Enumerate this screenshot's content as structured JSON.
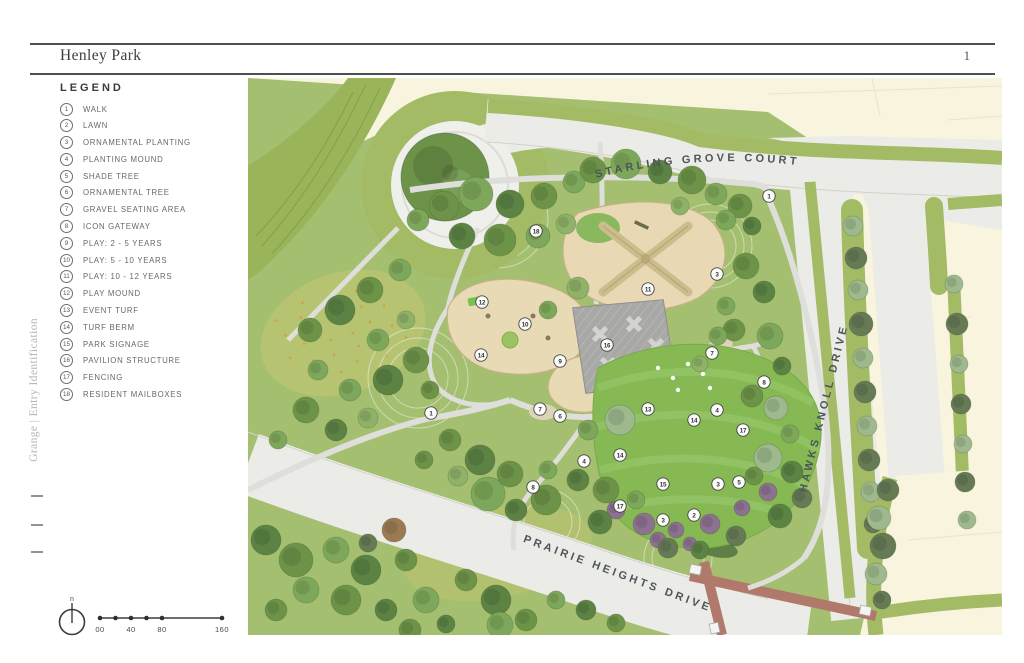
{
  "page": {
    "title": "Henley Park",
    "page_number": "1"
  },
  "sidebar_vertical_label": "Grange | Entry Identification",
  "legend": {
    "title": "LEGEND",
    "items": [
      {
        "num": "1",
        "label": "WALK"
      },
      {
        "num": "2",
        "label": "LAWN"
      },
      {
        "num": "3",
        "label": "ORNAMENTAL PLANTING"
      },
      {
        "num": "4",
        "label": "PLANTING MOUND"
      },
      {
        "num": "5",
        "label": "SHADE TREE"
      },
      {
        "num": "6",
        "label": "ORNAMENTAL TREE"
      },
      {
        "num": "7",
        "label": "GRAVEL SEATING AREA"
      },
      {
        "num": "8",
        "label": "ICON GATEWAY"
      },
      {
        "num": "9",
        "label": "PLAY: 2 - 5 YEARS"
      },
      {
        "num": "10",
        "label": "PLAY: 5 - 10 YEARS"
      },
      {
        "num": "11",
        "label": "PLAY: 10 - 12 YEARS"
      },
      {
        "num": "12",
        "label": "PLAY MOUND"
      },
      {
        "num": "13",
        "label": "EVENT TURF"
      },
      {
        "num": "14",
        "label": "TURF BERM"
      },
      {
        "num": "15",
        "label": "PARK SIGNAGE"
      },
      {
        "num": "16",
        "label": "PAVILION STRUCTURE"
      },
      {
        "num": "17",
        "label": "FENCING"
      },
      {
        "num": "18",
        "label": "RESIDENT MAILBOXES"
      }
    ]
  },
  "scale_bar": {
    "labels": [
      "00",
      "40",
      "80",
      "160"
    ],
    "north_label": "n"
  },
  "map": {
    "street_labels": {
      "top": "STARLING GROVE COURT",
      "right": "HAWKS KNOLL DRIVE",
      "bottom": "PRAIRIE HEIGHTS DRIVE"
    },
    "markers": [
      {
        "n": "1",
        "x": 521,
        "y": 118
      },
      {
        "n": "18",
        "x": 288,
        "y": 153
      },
      {
        "n": "3",
        "x": 469,
        "y": 196
      },
      {
        "n": "11",
        "x": 400,
        "y": 211
      },
      {
        "n": "12",
        "x": 234,
        "y": 224
      },
      {
        "n": "10",
        "x": 277,
        "y": 246
      },
      {
        "n": "16",
        "x": 359,
        "y": 267
      },
      {
        "n": "14",
        "x": 233,
        "y": 277
      },
      {
        "n": "9",
        "x": 312,
        "y": 283
      },
      {
        "n": "7",
        "x": 464,
        "y": 275
      },
      {
        "n": "8",
        "x": 516,
        "y": 304
      },
      {
        "n": "7",
        "x": 292,
        "y": 331
      },
      {
        "n": "6",
        "x": 312,
        "y": 338
      },
      {
        "n": "1",
        "x": 183,
        "y": 335
      },
      {
        "n": "13",
        "x": 400,
        "y": 331
      },
      {
        "n": "4",
        "x": 469,
        "y": 332
      },
      {
        "n": "14",
        "x": 446,
        "y": 342
      },
      {
        "n": "17",
        "x": 495,
        "y": 352
      },
      {
        "n": "4",
        "x": 336,
        "y": 383
      },
      {
        "n": "14",
        "x": 372,
        "y": 377
      },
      {
        "n": "15",
        "x": 415,
        "y": 406
      },
      {
        "n": "8",
        "x": 285,
        "y": 409
      },
      {
        "n": "17",
        "x": 372,
        "y": 428
      },
      {
        "n": "3",
        "x": 415,
        "y": 442
      },
      {
        "n": "2",
        "x": 446,
        "y": 437
      },
      {
        "n": "3",
        "x": 470,
        "y": 406
      },
      {
        "n": "5",
        "x": 491,
        "y": 404
      }
    ],
    "colors": {
      "cream": "#f8f4de",
      "road": "#ebebe8",
      "verge": "#a4bb66",
      "park": "#a3bf6f",
      "lawn": "#86b853",
      "sand": "#e9dab6",
      "pavilion": "#a8a8a6",
      "terracotta": "#b1796c"
    }
  }
}
